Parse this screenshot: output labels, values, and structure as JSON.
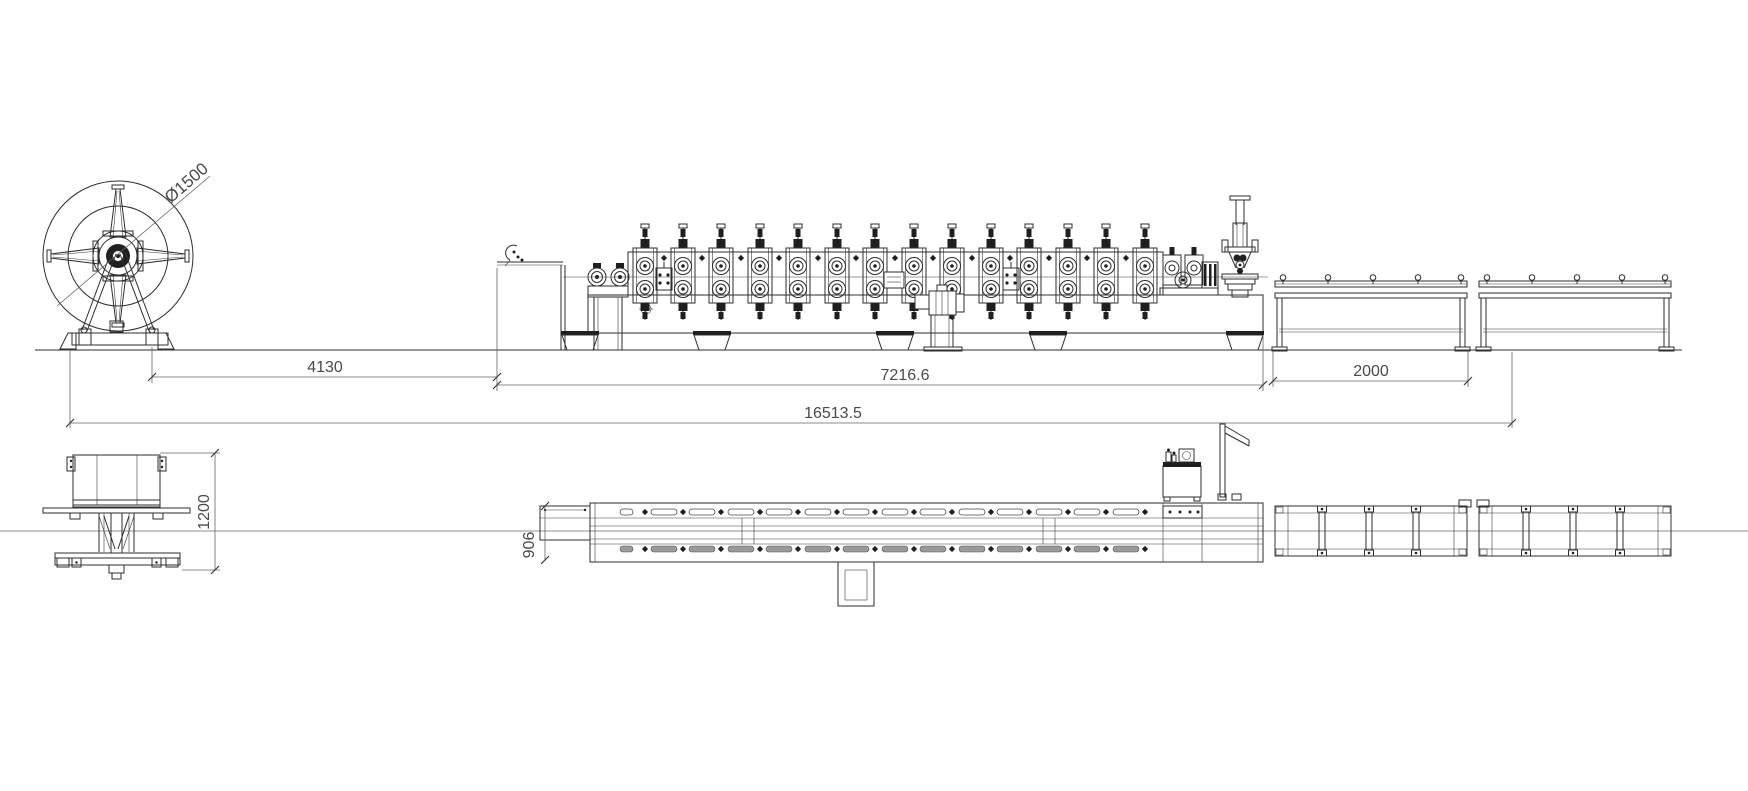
{
  "drawing": {
    "background": "#ffffff",
    "line_color": "#2e2e2e",
    "dim_color": "#646464",
    "dim_text_color": "#4a4a4a",
    "dimensions": {
      "coil_diameter": "Ø1500",
      "uncoiler_to_machine": "4130",
      "machine_length": "7216.6",
      "total_line_length": "16513.5",
      "runout_table_length": "2000",
      "uncoiler_width": "1200",
      "machine_inlet_width": "906"
    }
  }
}
